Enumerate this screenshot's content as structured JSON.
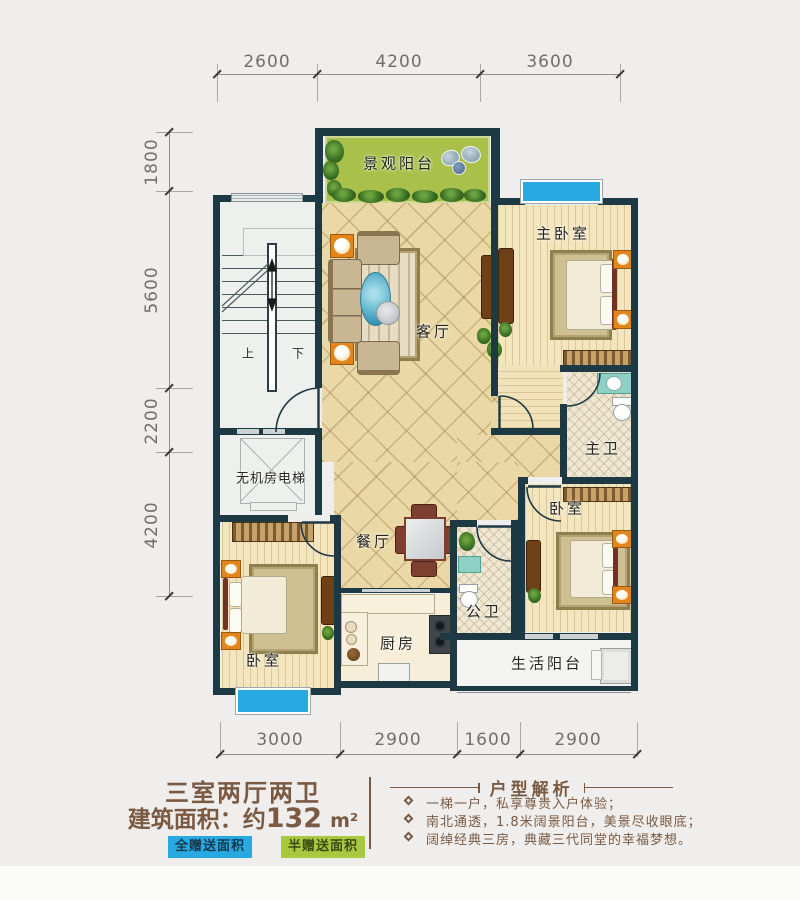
{
  "dimensions": {
    "top": [
      "2600",
      "4200",
      "3600"
    ],
    "left": [
      "1800",
      "5600",
      "2200",
      "4200"
    ],
    "bottom": [
      "3000",
      "2900",
      "1600",
      "2900"
    ]
  },
  "rooms": {
    "view_balcony": "景观阳台",
    "master_bedroom": "主卧室",
    "living": "客厅",
    "master_bath": "主卫",
    "bedroom_right": "卧室",
    "bedroom_left": "卧室",
    "dining": "餐厅",
    "kitchen": "厨房",
    "public_bath": "公卫",
    "life_balcony": "生活阳台",
    "elevator": "无机房电梯",
    "stairs_up": "上",
    "stairs_down": "下"
  },
  "summary": {
    "title": "三室两厅两卫",
    "area_label": "建筑面积：约",
    "area_value": "132",
    "area_unit": "m²",
    "legend_full": "全赠送面积",
    "legend_half": "半赠送面积"
  },
  "analysis": {
    "title": "户型解析",
    "bullets": [
      "一梯一户，私享尊贵入户体验；",
      "南北通透，1.8米阔景阳台，美景尽收眼底；",
      "阔绰经典三房，典藏三代同堂的幸福梦想。"
    ]
  },
  "colors": {
    "wall": "#1d3944",
    "window_blue": "#29a9e1",
    "balcony_green": "#a9c14b",
    "legend_green": "#a8c83f",
    "text_brown": "#7a5a43"
  }
}
